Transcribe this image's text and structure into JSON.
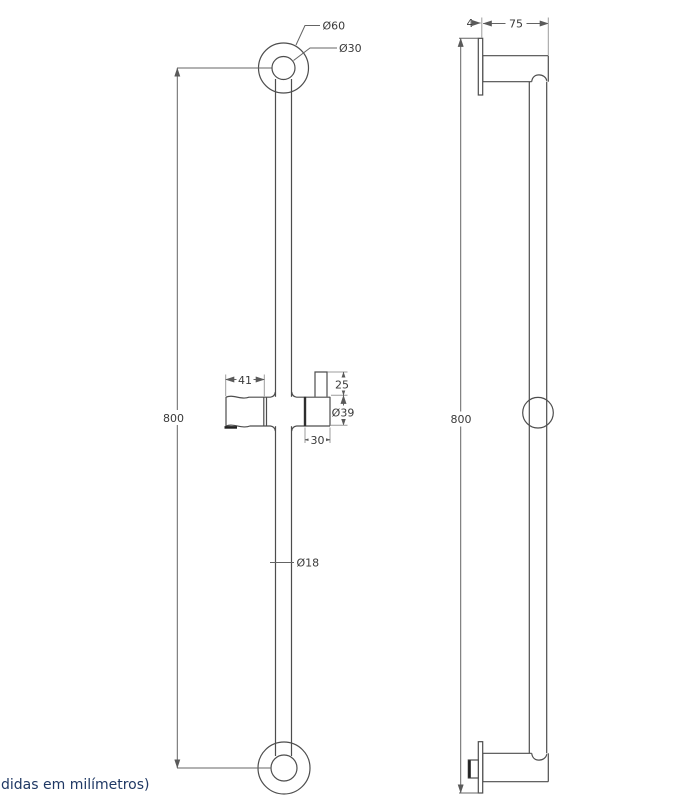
{
  "meta": {
    "drawing_type": "technical drawing",
    "subject": "shower slide bar, front and side views"
  },
  "colors": {
    "background": "#ffffff",
    "outline": "#4d4d4d",
    "dimension_line": "#646464",
    "extension_line": "#9c9c9c",
    "dimension_text": "#3a3a3a",
    "footer_text": "#1f3864"
  },
  "front_view": {
    "labels": {
      "flange_outer_diameter": "Ø60",
      "flange_inner_diameter": "Ø30",
      "overall_height": "800",
      "holder_arm_length": "41",
      "clamp_height": "25",
      "knob_diameter": "Ø39",
      "knob_width": "30",
      "bar_diameter": "Ø18"
    }
  },
  "side_view": {
    "labels": {
      "plate_thickness": "4",
      "wall_offset": "75",
      "overall_height": "800"
    }
  },
  "footer": {
    "units_note": "didas em milímetros)"
  }
}
